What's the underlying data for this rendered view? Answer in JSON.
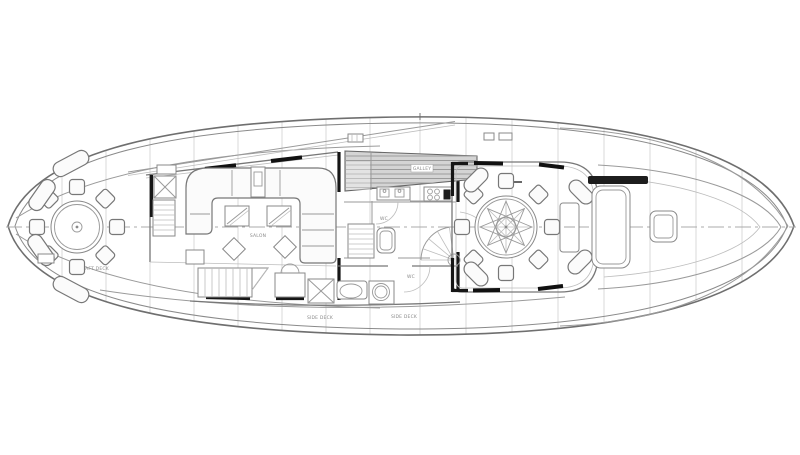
{
  "diagram": {
    "type": "yacht-main-deck-floor-plan",
    "orientation": "bow-right-stern-left"
  },
  "colors": {
    "background": "#ffffff",
    "outline": "#6f6f6f",
    "wall": "#161616",
    "grid": "#cfcfcf",
    "skylight_hatch": "#d4d4d4",
    "furniture_fill": "#fbfbfb",
    "label_text": "#8a8a8a"
  },
  "plan": {
    "labels": {
      "aft_deck": "AFT DECK",
      "salon": "SALON",
      "galley": "GALLEY",
      "head": "WC",
      "bath": "WC",
      "side_deck_left": "SIDE DECK",
      "side_deck_right": "SIDE DECK"
    }
  }
}
